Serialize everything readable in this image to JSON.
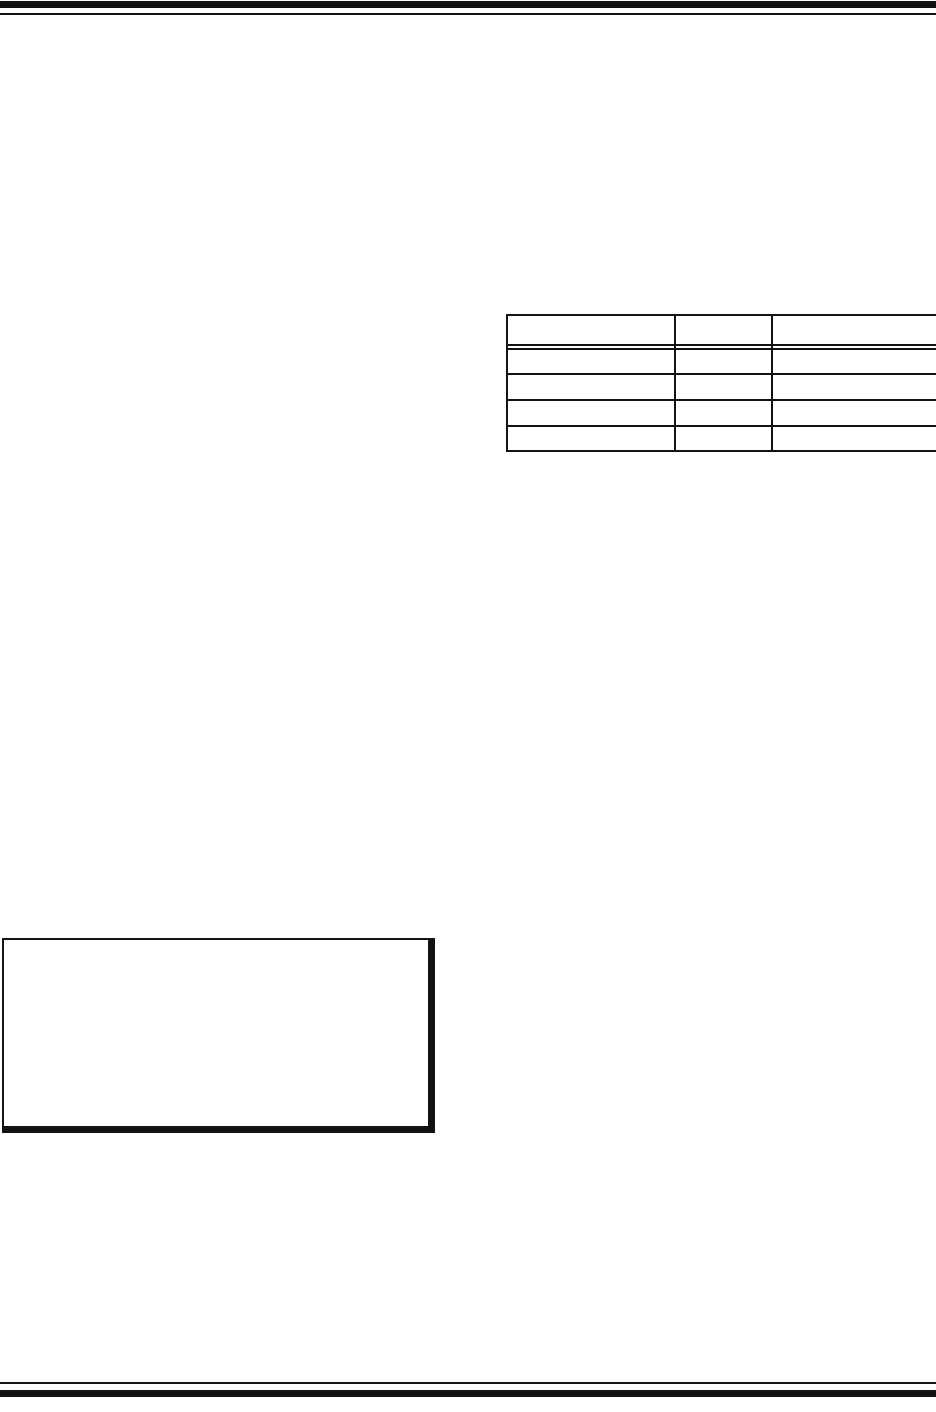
{
  "page": {
    "background_color": "#ffffff",
    "rule_color": "#121212"
  },
  "table": {
    "header": [
      "",
      "",
      ""
    ],
    "rows": [
      [
        "",
        "",
        ""
      ],
      [
        "",
        "",
        ""
      ],
      [
        "",
        "",
        ""
      ],
      [
        "",
        "",
        ""
      ]
    ]
  },
  "note_box": {
    "text": ""
  }
}
